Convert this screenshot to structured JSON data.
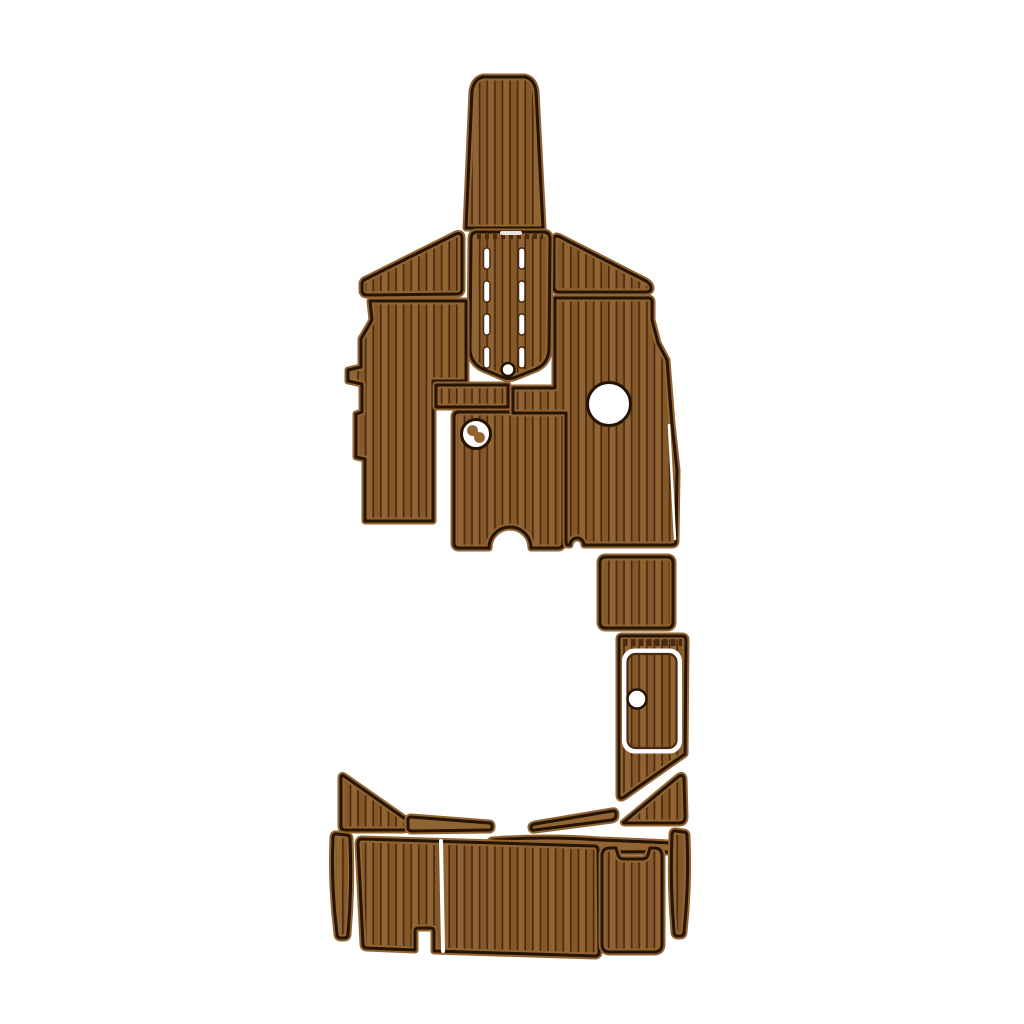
{
  "image": {
    "kind": "product-photo",
    "subject": "EVA foam faux-teak boat decking pad kit on white background",
    "text_visible": ""
  },
  "colors": {
    "background": "#ffffff",
    "deck_base": "#916433",
    "deck_base_alt": "#855829",
    "plank_line": "#4a2b10",
    "outline": "#261402",
    "seam": "#ffffff"
  },
  "planks": {
    "spacing_px": 7.6,
    "line_width_px": 1.7,
    "direction_default": "vertical"
  },
  "pieces": [
    {
      "id": "bow-pad",
      "label": "bow pad",
      "solid": false
    },
    {
      "id": "port-top-strip",
      "label": "port top strip",
      "solid": false
    },
    {
      "id": "starboard-top-strip",
      "label": "starboard top strip",
      "solid": false
    },
    {
      "id": "helm-hatch-pad",
      "label": "center hatch pad with drain slots",
      "solid": false
    },
    {
      "id": "port-cockpit-pad",
      "label": "port cockpit pad",
      "solid": false
    },
    {
      "id": "center-small-pad",
      "label": "small center pad",
      "solid": false
    },
    {
      "id": "mid-cockpit-pad",
      "label": "mid cockpit pad with keyhole notch",
      "solid": false
    },
    {
      "id": "starboard-cockpit-pad",
      "label": "starboard cockpit pad with seat-base cutout",
      "solid": false
    },
    {
      "id": "step-pad",
      "label": "square step pad",
      "solid": false
    },
    {
      "id": "engine-hatch-pad",
      "label": "engine hatch pad",
      "solid": false
    },
    {
      "id": "starboard-wedge",
      "label": "starboard wedge pad",
      "solid": false
    },
    {
      "id": "port-wedge",
      "label": "port wedge pad",
      "solid": false
    },
    {
      "id": "port-trim-strip",
      "label": "port trim strip",
      "solid": true
    },
    {
      "id": "center-trim-strip",
      "label": "center trim strip",
      "solid": true
    },
    {
      "id": "starboard-trim-strip",
      "label": "starboard trim strip",
      "solid": true
    },
    {
      "id": "swim-platform-pad",
      "label": "swim platform pad with bottom notch",
      "solid": false
    },
    {
      "id": "transom-step-pad",
      "label": "transom step pad with top notch",
      "solid": false
    },
    {
      "id": "starboard-edge-strip",
      "label": "starboard edge strip",
      "solid": false
    },
    {
      "id": "port-edge-strip",
      "label": "port edge strip",
      "solid": false
    }
  ]
}
